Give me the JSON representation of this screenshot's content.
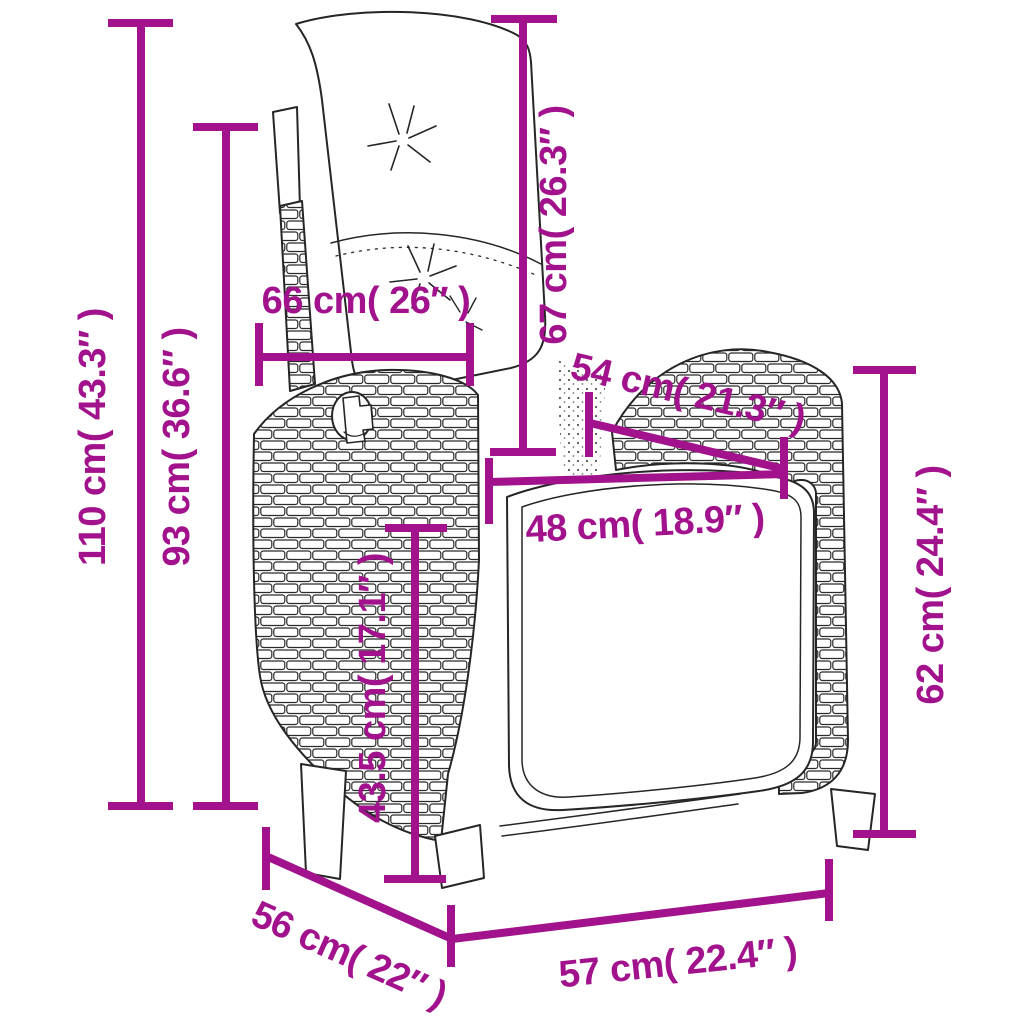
{
  "diagram": {
    "subject": "Reclining rattan garden chair with cushions - dimension diagram",
    "accent_color": "#A1128C",
    "line_art_color": "#262626",
    "background_color": "#FFFFFF"
  },
  "dimensions": {
    "height_total": {
      "label": "110 cm( 43.3″ )"
    },
    "height_backrest": {
      "label": "93 cm( 36.6″ )"
    },
    "width_backrest_top": {
      "label": "66 cm( 26″ )"
    },
    "back_cushion_height": {
      "label": "67 cm( 26.3″ )"
    },
    "seat_depth": {
      "label": "54 cm( 21.3″ )"
    },
    "seat_width": {
      "label": "48 cm( 18.9″ )"
    },
    "seat_height": {
      "label": "43.5 cm( 17.1″ )"
    },
    "armrest_height": {
      "label": "62 cm( 24.4″ )"
    },
    "base_depth": {
      "label": "56 cm( 22″ )"
    },
    "base_width": {
      "label": "57 cm( 22.4″ )"
    }
  }
}
